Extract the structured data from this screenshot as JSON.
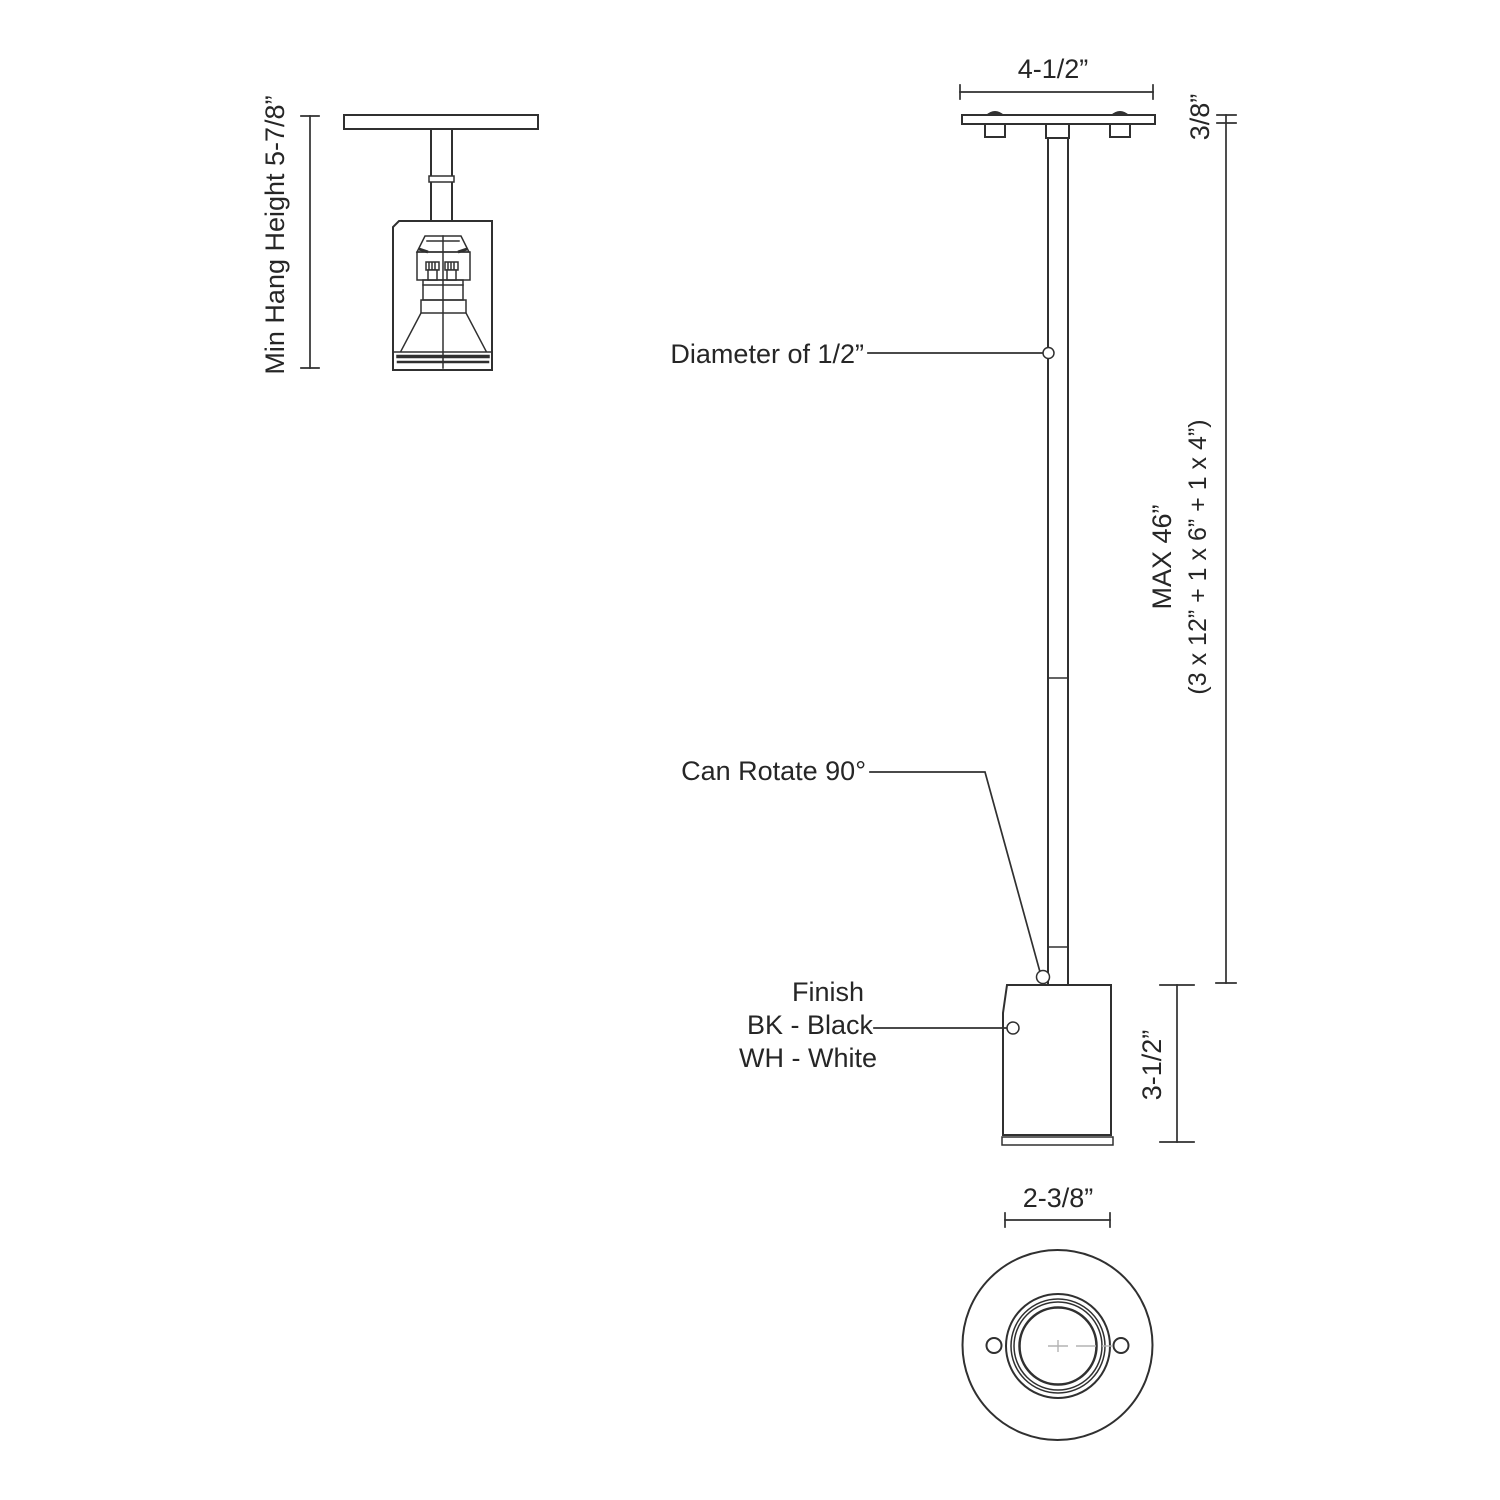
{
  "diagram": {
    "colors": {
      "line": "#303030",
      "text": "#262626",
      "centerline": "#b3b3b3",
      "background": "#ffffff"
    },
    "labels": {
      "min_hang_height": "Min Hang Height 5-7/8”",
      "canopy_width": "4-1/2”",
      "canopy_thickness": "3/8”",
      "rod_diameter": "Diameter of 1/2”",
      "max_length_line1": "MAX 46”",
      "max_length_line2": "(3 x 12” + 1 x 6” + 1 x 4”)",
      "can_rotate": "Can Rotate 90°",
      "finish_title": "Finish",
      "finish_black": "BK - Black",
      "finish_white": "WH - White",
      "head_height": "3-1/2”",
      "head_diameter": "2-3/8”"
    }
  }
}
